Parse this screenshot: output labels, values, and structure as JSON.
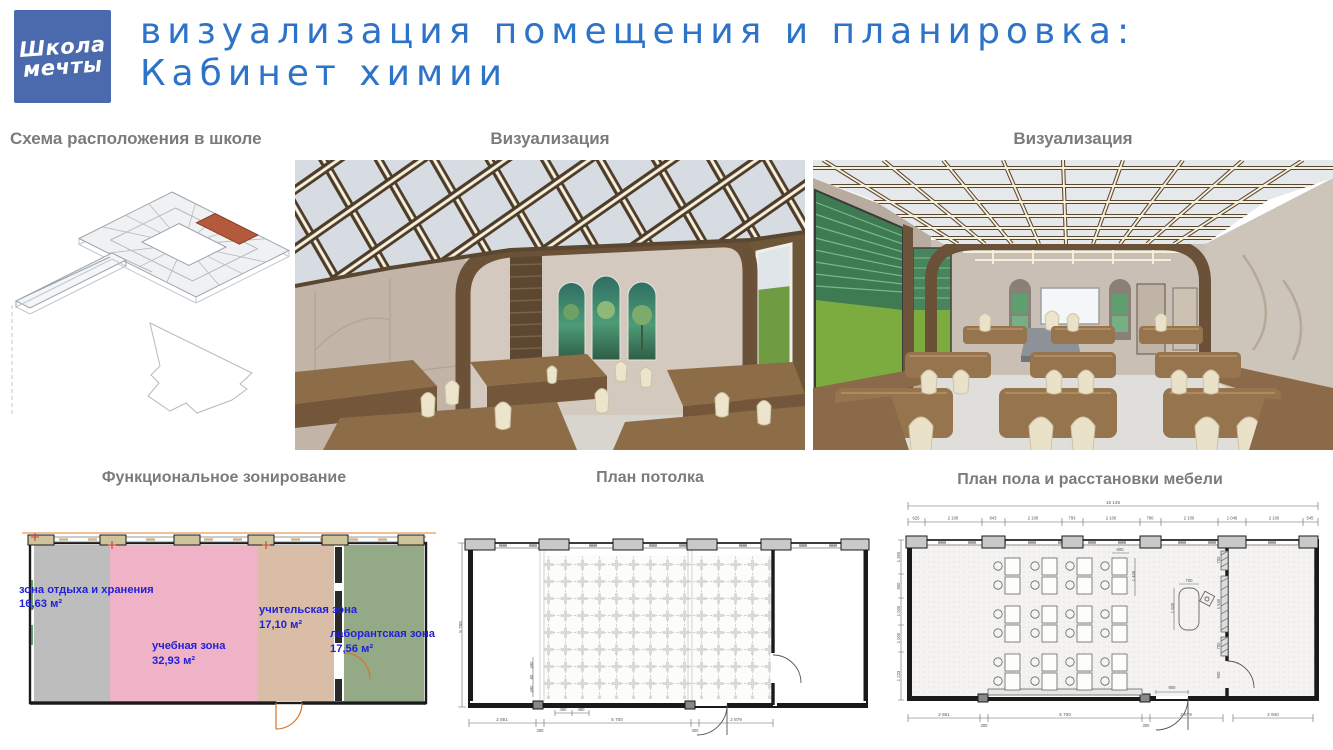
{
  "slide": {
    "logo": {
      "line1": "Школа",
      "line2": "мечты",
      "bg": "#4b69ad"
    },
    "title_line1": "визуализация помещения и планировка:",
    "title_line2": "Кабинет химии",
    "title_color": "#2d73c8"
  },
  "panels": {
    "scheme_title": "Схема расположения в школе",
    "viz1_title": "Визуализация",
    "viz2_title": "Визуализация",
    "zoning_title": "Функциональное зонирование",
    "ceiling_title": "План потолка",
    "floor_title": "План пола и расстановки мебели"
  },
  "zoning": {
    "label_color": "#2121d8",
    "highlight_color": "#b25a3b",
    "zones": [
      {
        "name": "зона отдыха и хранения",
        "area": "16,63 м²",
        "color": "#bdbdbd"
      },
      {
        "name": "учебная зона",
        "area": "32,93 м²",
        "color": "#efb2c6"
      },
      {
        "name": "учительская зона",
        "area": "17,10 м²",
        "color": "#d9bda6"
      },
      {
        "name": "лаборантская зона",
        "area": "17,56 м²",
        "color": "#94aa86"
      }
    ]
  },
  "ceiling_plan": {
    "left_dim": "5 788",
    "bottom_dims": [
      "2 651",
      "300",
      "5 700",
      "300",
      "2 879"
    ],
    "inner_h": [
      "490",
      "490"
    ],
    "inner_v": [
      "490",
      "80",
      "490"
    ]
  },
  "floor_plan": {
    "overall_width": "15 145",
    "top_dims": [
      "625",
      "2 100",
      "843",
      "2 100",
      "793",
      "2 100",
      "780",
      "2 100",
      "1 046",
      "2 100",
      "545"
    ],
    "bottom_dims": [
      "2 651",
      "300",
      "5 700",
      "300",
      "2 679",
      "2 940"
    ],
    "left_dims": [
      "1 350",
      "900",
      "1 000",
      "1 000",
      "1 223"
    ],
    "desk_w": "600",
    "desk_h": "1 400",
    "teacher_w": "700",
    "teacher_h": "1 500",
    "shelf_top": "700",
    "shelf_mid": "1 540",
    "shelf_bot": "700",
    "door_side": "900",
    "door_bottom": "900"
  }
}
